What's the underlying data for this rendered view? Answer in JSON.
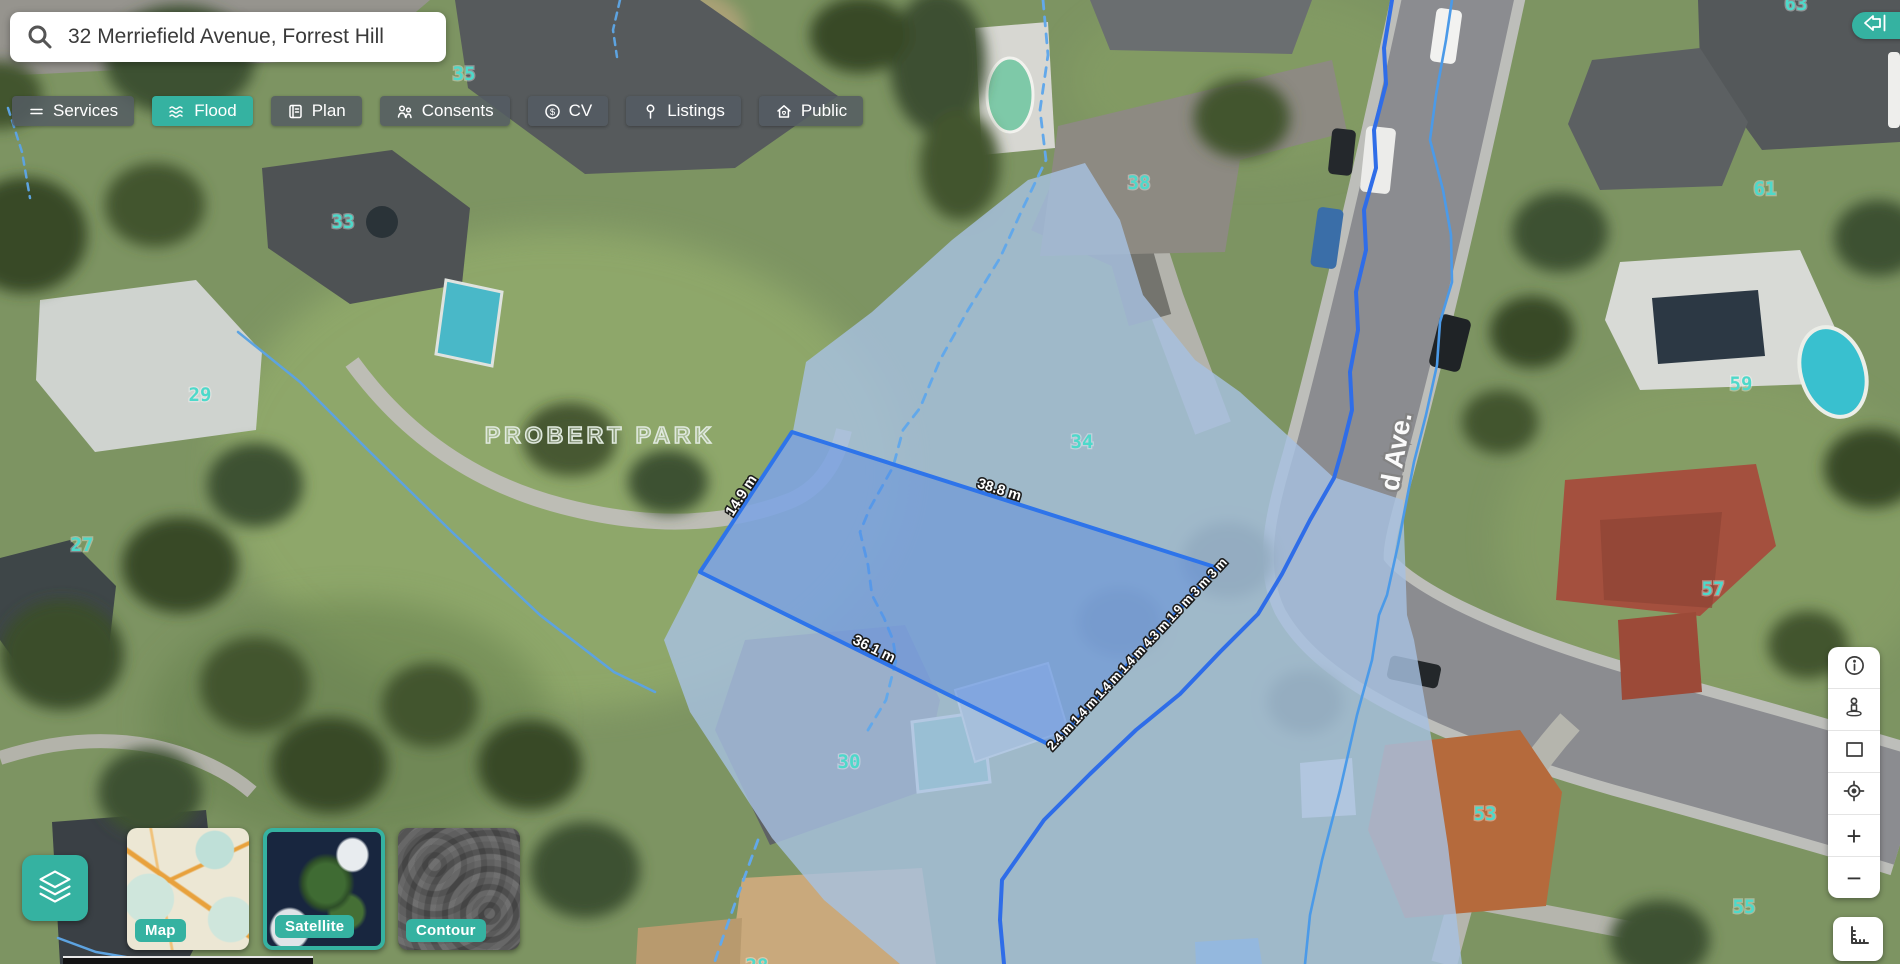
{
  "app": {
    "accent_color": "#35b2a1"
  },
  "search": {
    "value": "32 Merriefield Avenue, Forrest Hill",
    "icon": "search-icon"
  },
  "toolbar": {
    "buttons": [
      {
        "label": "Services",
        "icon": "services-icon",
        "active": false
      },
      {
        "label": "Flood",
        "icon": "flood-waves-icon",
        "active": true
      },
      {
        "label": "Plan",
        "icon": "plan-book-icon",
        "active": false
      },
      {
        "label": "Consents",
        "icon": "consents-people-icon",
        "active": false
      },
      {
        "label": "CV",
        "icon": "cv-dollar-icon",
        "active": false
      },
      {
        "label": "Listings",
        "icon": "listings-pin-icon",
        "active": false
      },
      {
        "label": "Public",
        "icon": "public-house-icon",
        "active": false
      }
    ]
  },
  "map": {
    "park_label": "PROBERT PARK",
    "street_label": "d Ave.",
    "house_numbers": [
      "35",
      "33",
      "29",
      "27",
      "63",
      "61",
      "38",
      "34",
      "59",
      "57",
      "30",
      "53",
      "55",
      "28"
    ],
    "house_number_color": "#4ed9ca",
    "parcel": {
      "dim_left": "14.9 m",
      "dim_top": "38.8 m",
      "dim_bottom": "36.1 m",
      "dim_right_chain": "2.4 m 1.4 m 1.4 m 1.4 m 4.3 m 1.9 m 3 m 3 m",
      "stroke": "#2e74ea"
    },
    "flood": {
      "fill": "#a7c1e0",
      "boundary_color": "#2f6de8",
      "stream_color": "#5da3e0"
    }
  },
  "basemap_switcher": {
    "layers_button_icon": "layers-icon",
    "options": [
      {
        "label": "Map",
        "selected": false
      },
      {
        "label": "Satellite",
        "selected": true
      },
      {
        "label": "Contour",
        "selected": false
      }
    ]
  },
  "right_toolbar": {
    "buttons": [
      {
        "icon": "info-icon"
      },
      {
        "icon": "street-view-pegman-icon"
      },
      {
        "icon": "draw-rectangle-icon"
      },
      {
        "icon": "locate-icon"
      },
      {
        "icon": "zoom-in-icon",
        "glyph": "+"
      },
      {
        "icon": "zoom-out-icon",
        "glyph": "−"
      }
    ],
    "measure_button_icon": "measure-ruler-icon"
  },
  "panel_toggle": {
    "icon": "collapse-left-icon"
  }
}
